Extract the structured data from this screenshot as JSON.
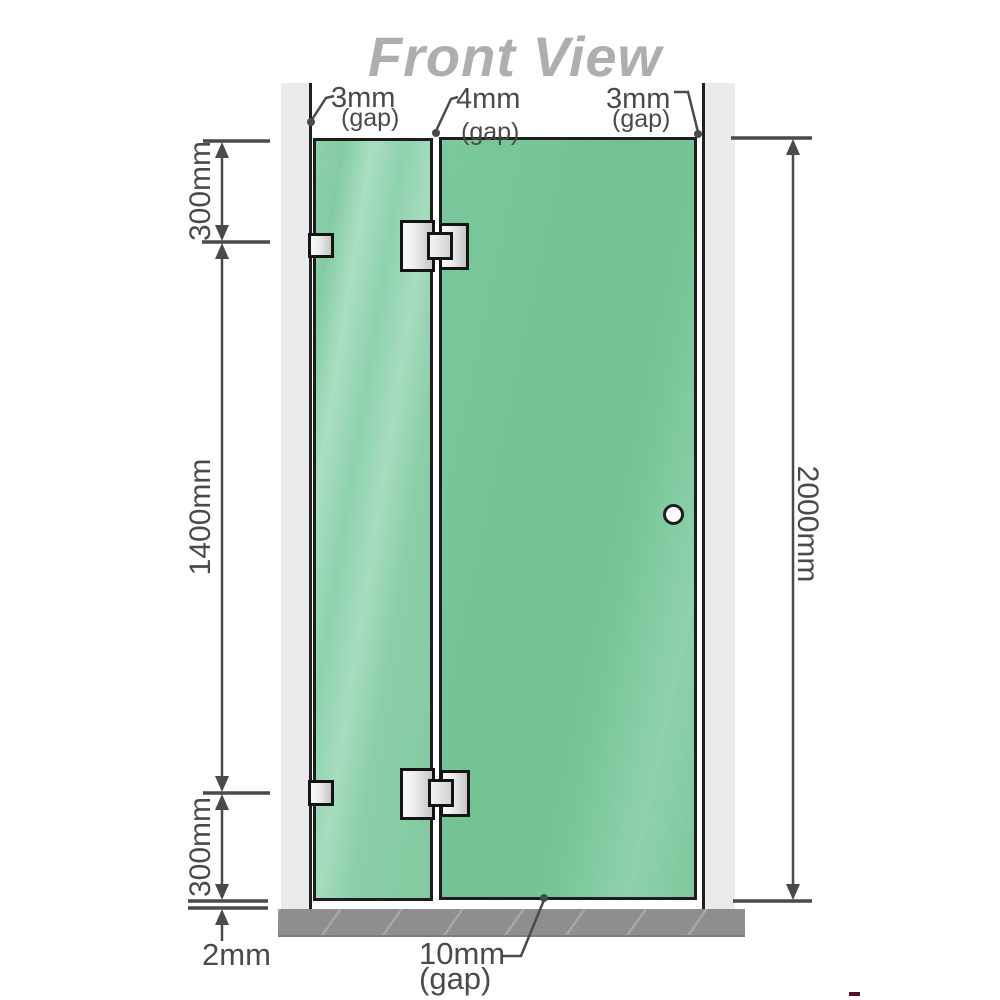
{
  "title": "Front View",
  "annotations": {
    "gap_top_left": {
      "value": "3mm",
      "unit": "(gap)"
    },
    "gap_top_middle": {
      "value": "4mm",
      "unit": "(gap)"
    },
    "gap_top_right": {
      "value": "3mm",
      "unit": "(gap)"
    },
    "gap_bottom": {
      "value": "10mm",
      "unit": "(gap)"
    },
    "segment_top": "300mm",
    "segment_middle": "1400mm",
    "segment_bottom": "300mm",
    "floor_clearance": "2mm",
    "total_height": "2000mm"
  },
  "colors": {
    "glass_green": "#74c396",
    "glass_highlight": "#a9dec2",
    "wall_gray": "#eaeaea",
    "floor_gray": "#8e8e8e",
    "hardware_silver": "#e0e0e0",
    "outline_black": "#1e1e1e",
    "dimension_gray": "#4a4a4a",
    "title_gray": "#aeaeae"
  }
}
